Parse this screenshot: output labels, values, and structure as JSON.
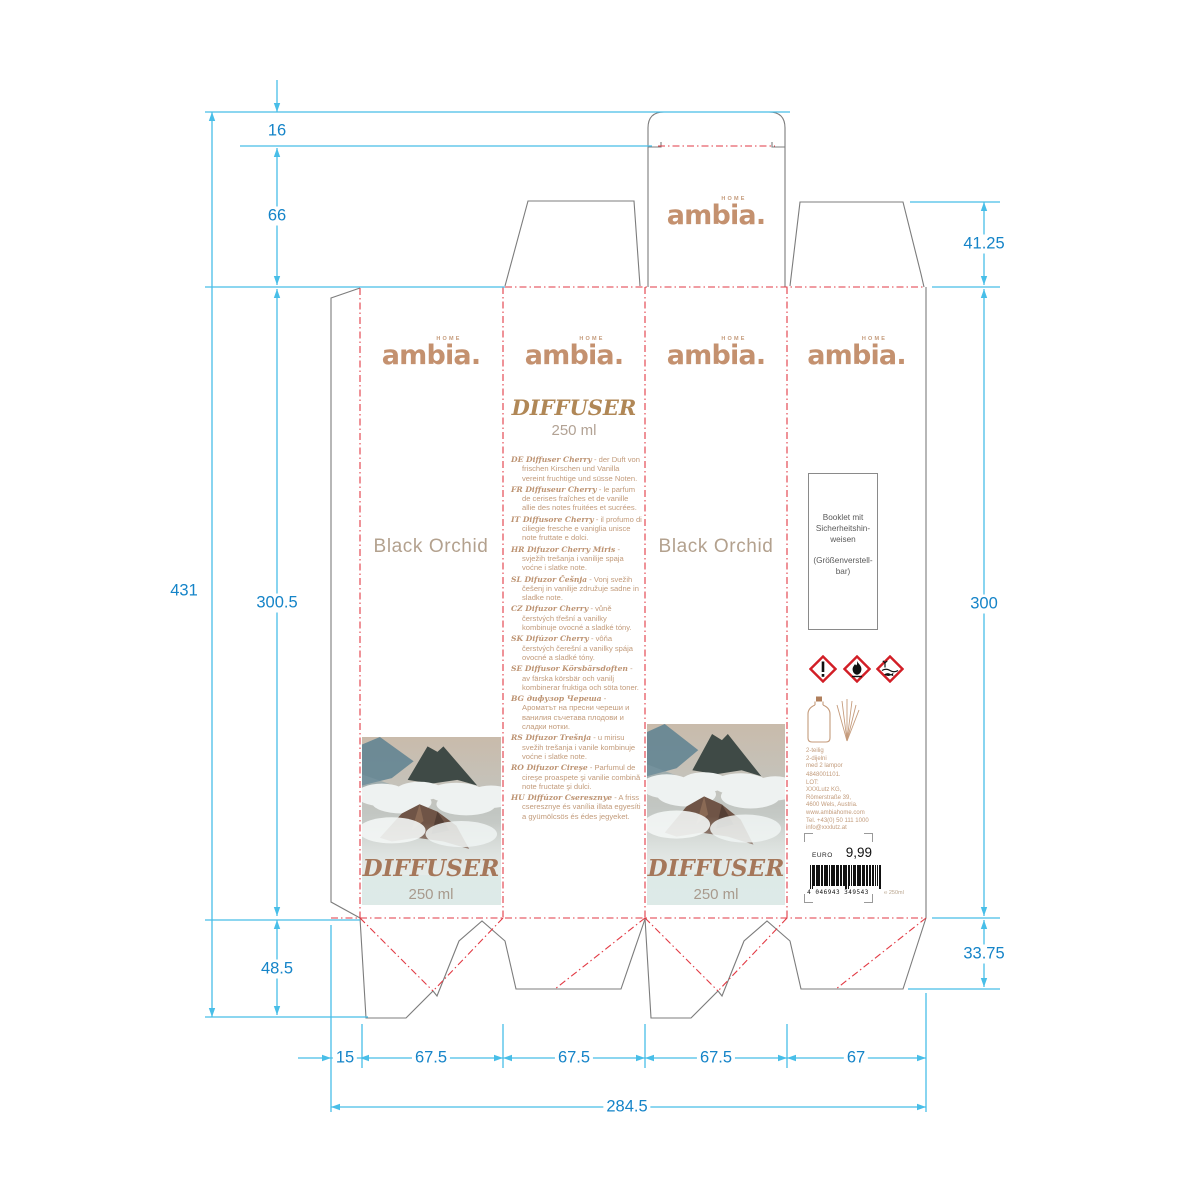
{
  "drawing": {
    "brand": {
      "name": "ambia.",
      "tagline": "HOME"
    },
    "dims": {
      "d16": "16",
      "d66": "66",
      "d431": "431",
      "d300_5": "300.5",
      "d48_5": "48.5",
      "d41_25": "41.25",
      "d300": "300",
      "d33_75": "33.75",
      "d15": "15",
      "w1": "67.5",
      "w2": "67.5",
      "w3": "67.5",
      "w4": "67",
      "total": "284.5"
    }
  },
  "panels": {
    "back": {
      "scent": "Black Orchid",
      "product": "DIFFUSER",
      "volume": "250 ml"
    },
    "front": {
      "scent": "Black Orchid",
      "product": "DIFFUSER",
      "volume": "250 ml"
    },
    "info": {
      "title": "DIFFUSER",
      "volume": "250 ml",
      "descriptions": [
        {
          "name": "DE Diffuser Cherry",
          "text": "der Duft von frischen Kirschen und Vanilla vereint fruchtige und süsse Noten."
        },
        {
          "name": "FR Diffuseur Cherry",
          "text": "le parfum de cerises fraîches et de vanille allie des notes fruitées et sucrées."
        },
        {
          "name": "IT Diffusore Cherry",
          "text": "il profumo di ciliegie fresche e vaniglia unisce note fruttate e dolci."
        },
        {
          "name": "HR Difuzor Cherry Miris",
          "text": "svježih trešanja i vanilije spaja voćne i slatke note."
        },
        {
          "name": "SL Difuzor Češnja",
          "text": "Vonj svežih češenj in vanilije združuje sadne in sladke note."
        },
        {
          "name": "CZ Difuzor Cherry",
          "text": "vůně čerstvých třešní a vanilky kombinuje ovocné a sladké tóny."
        },
        {
          "name": "SK Difúzor Cherry",
          "text": "vôňa čerstvých čerešní a vanilky spája ovocné a sladké tóny."
        },
        {
          "name": "SE Diffusor Körsbärsdoften",
          "text": "av färska körsbär och vanilj kombinerar fruktiga och söta toner."
        },
        {
          "name": "BG дифузор Череша",
          "text": "Ароматът на пресни череши и ванилия съчетава плодови и сладки нотки."
        },
        {
          "name": "RS Difuzor Trešnja",
          "text": "u mirisu svežih trešanja i vanile kombinuje voćne i slatke note."
        },
        {
          "name": "RO Difuzor Cireşe",
          "text": "Parfumul de cireşe proaspete şi vanilie combină note fructate şi dulci."
        },
        {
          "name": "HU Diffúzor Cseresznye",
          "text": "A friss cseresznye és vanília illata egyesíti a gyümölcsös és édes jegyeket."
        }
      ]
    },
    "side": {
      "booklet_lines": [
        "Booklet mit",
        "Sicherheitshin-",
        "weisen",
        "",
        "(Größenverstell-",
        "bar)"
      ],
      "hazard_icons": [
        "exclamation-mark",
        "flame",
        "environment-hazard"
      ],
      "contents_lines": [
        "2-teilig",
        "2-dijelni",
        "med 2 lampor"
      ],
      "address_lines": [
        "4848001101.",
        "LOT:",
        "XXXLutz KG,",
        "Römerstraße 39,",
        "4600 Wels, Austria.",
        "www.ambiahome.com",
        "Tel. +43(0) 50 111 1000",
        "info@xxxlutz.at"
      ],
      "price_label": "EURO",
      "price": "9,99",
      "barcode_text": "4 046943 349543",
      "unit_note": "℮ 250ml"
    }
  },
  "colors": {
    "accent": "#c4916f",
    "dimension_line": "#48bee8",
    "dimension_text": "#1584c8",
    "fold_line": "#e23a44",
    "cut_line": "#7c7c7c",
    "hazard_red": "#d21e26"
  }
}
